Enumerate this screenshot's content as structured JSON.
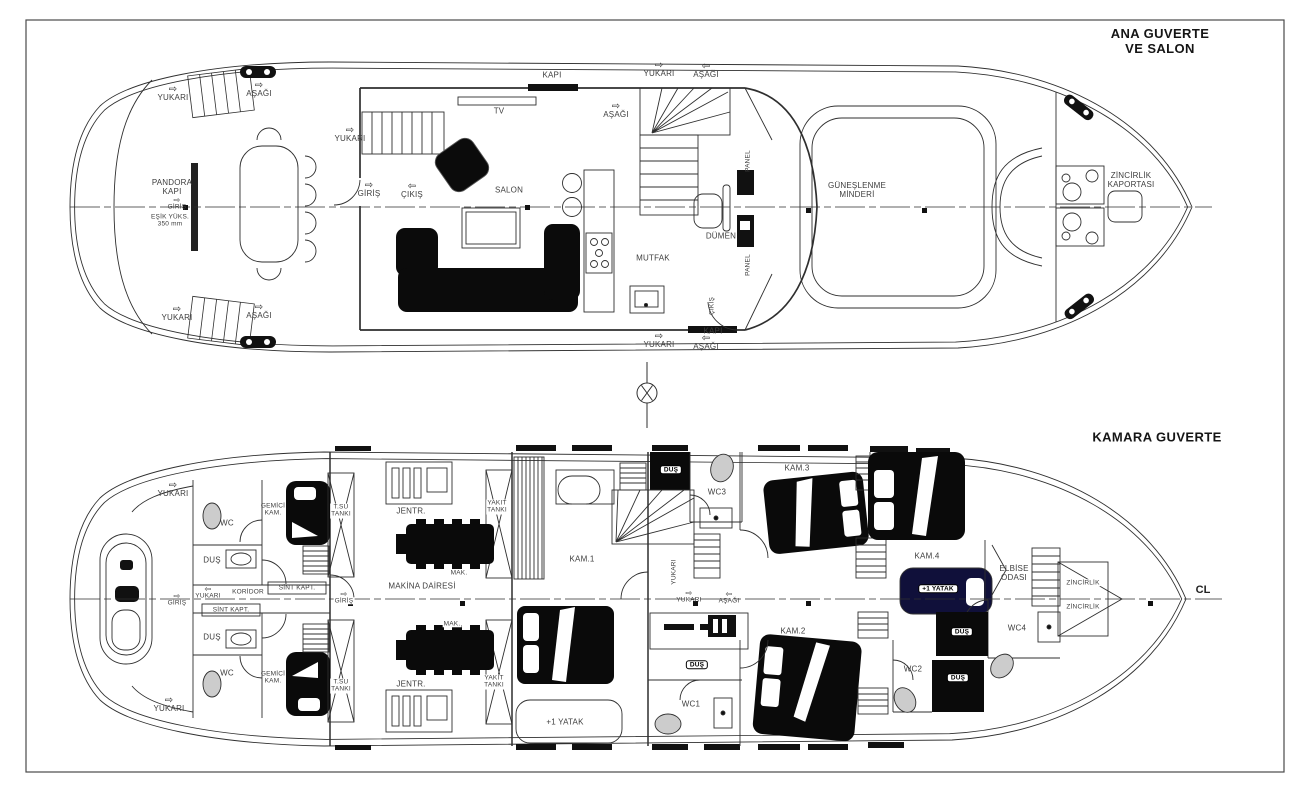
{
  "drawing": {
    "type": "yacht-deck-plan",
    "icons": {
      "right": "⇨",
      "left": "⇦"
    },
    "main_deck": {
      "title": "ANA GUVERTE\nVE SALON",
      "labels": [
        {
          "text": "YUKARI"
        },
        {
          "text": "AŞAĞI"
        },
        {
          "text": "YUKARI"
        },
        {
          "text": "GİRİŞ"
        },
        {
          "text": "ÇIKIŞ"
        },
        {
          "text": "PANDORA\nKAPI"
        },
        {
          "text": "GİRİŞ"
        },
        {
          "text": "EŞİK YÜKS.\n350 mm"
        },
        {
          "text": "KAPI"
        },
        {
          "text": "TV"
        },
        {
          "text": "SALON"
        },
        {
          "text": "AŞAĞI"
        },
        {
          "text": "YUKARI"
        },
        {
          "text": "AŞAĞI"
        },
        {
          "text": "MUTFAK"
        },
        {
          "text": "DÜMEN"
        },
        {
          "text": "PANEL"
        },
        {
          "text": "PANEL"
        },
        {
          "text": "GÜNEŞLENME\nMİNDERİ"
        },
        {
          "text": "ZİNCİRLİK\nKAPORTASI"
        },
        {
          "text": "ÇIKIŞ"
        },
        {
          "text": "KAPI"
        },
        {
          "text": "YUKARI"
        },
        {
          "text": "AŞAĞI"
        },
        {
          "text": "YUKARI"
        },
        {
          "text": "AŞAĞI"
        }
      ]
    },
    "cabin_deck": {
      "title": "KAMARA GUVERTE",
      "centerline_label": "CL",
      "labels": [
        {
          "text": "YUKARI"
        },
        {
          "text": "YUKARI"
        },
        {
          "text": "GİRİŞ"
        },
        {
          "text": "WC"
        },
        {
          "text": "DUŞ"
        },
        {
          "text": "YUKARI"
        },
        {
          "text": "KORİDOR"
        },
        {
          "text": "SİNT KAPT."
        },
        {
          "text": "SİNT KAPT."
        },
        {
          "text": "DUŞ"
        },
        {
          "text": "WC"
        },
        {
          "text": "GEMİCİ\nKAM."
        },
        {
          "text": "GEMİCİ\nKAM."
        },
        {
          "text": "T.SU\nTANKI"
        },
        {
          "text": "T.SU\nTANKI"
        },
        {
          "text": "JENTR."
        },
        {
          "text": "JENTR."
        },
        {
          "text": "MAK."
        },
        {
          "text": "MAK."
        },
        {
          "text": "MAKİNA DAİRESİ"
        },
        {
          "text": "GİRİŞ"
        },
        {
          "text": "YAKIT\nTANKI"
        },
        {
          "text": "YAKIT\nTANKI"
        },
        {
          "text": "KAM.1"
        },
        {
          "text": "+1 YATAK"
        },
        {
          "text": "DUŞ"
        },
        {
          "text": "WC3"
        },
        {
          "text": "KAM.3"
        },
        {
          "text": "YUKARI"
        },
        {
          "text": "YUKARI"
        },
        {
          "text": "AŞAĞI"
        },
        {
          "text": "KAM.2"
        },
        {
          "text": "DUŞ"
        },
        {
          "text": "WC1"
        },
        {
          "text": "KAM.4"
        },
        {
          "text": "+1 YATAK"
        },
        {
          "text": "ELBİSE\nODASI"
        },
        {
          "text": "ZİNCİRLİK"
        },
        {
          "text": "ZİNCİRLİK"
        },
        {
          "text": "WC4"
        },
        {
          "text": "DUŞ"
        },
        {
          "text": "WC2"
        },
        {
          "text": "DUŞ"
        }
      ]
    }
  }
}
